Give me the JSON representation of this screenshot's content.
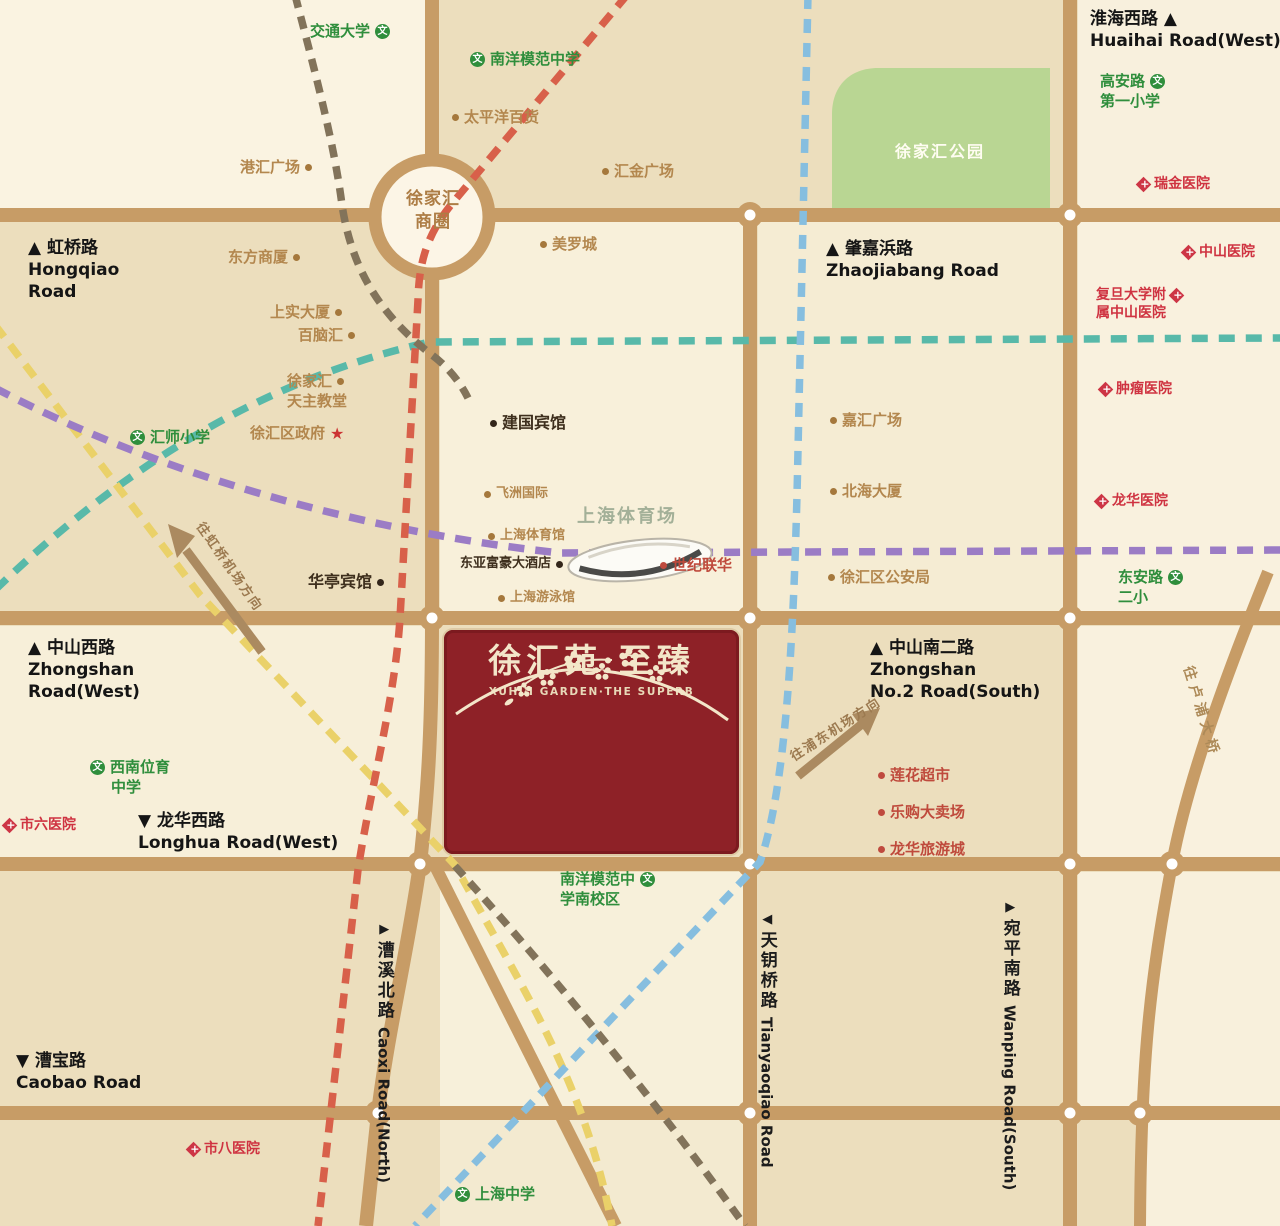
{
  "map": {
    "title": "徐汇苑·至臻 区位图",
    "project": {
      "name_cn": "徐汇苑·至臻",
      "name_en": "XUHUI GARDEN·THE SUPERB"
    },
    "hub": {
      "label": "徐家汇商圈"
    },
    "park": {
      "label": "徐家汇公园"
    },
    "colors": {
      "background": "#ecdebd",
      "block_light": "#f8f0da",
      "road": "#c79c66",
      "project_red": "#8e2127",
      "park_green": "#b9d693",
      "line_red": "#d8604a",
      "line_teal": "#58b9a9",
      "line_purple": "#9b7cc5",
      "line_yellow": "#ead169",
      "line_blue": "#86bedf",
      "line_brown": "#82735a",
      "poi_tan": "#b3874e",
      "school_green": "#2f8e3c",
      "hospital_red": "#cf3341"
    },
    "labels": [
      {
        "n": "poi-jiaotong-university",
        "x": 310,
        "y": 22,
        "c": "school",
        "lines": [
          {
            "t": "交通大学",
            "ic": "school",
            "s": "right"
          }
        ]
      },
      {
        "n": "poi-nanyang-model-school",
        "x": 470,
        "y": 50,
        "c": "school",
        "lines": [
          {
            "t": "南洋模范中学",
            "ic": "school",
            "s": "left"
          }
        ]
      },
      {
        "n": "poi-pacific-department-store",
        "x": 452,
        "y": 108,
        "c": "poi",
        "lines": [
          {
            "t": "太平洋百货",
            "ic": "dot-tan",
            "s": "left"
          }
        ]
      },
      {
        "n": "poi-ganghui-plaza",
        "x": 240,
        "y": 158,
        "c": "poi",
        "lines": [
          {
            "t": "港汇广场",
            "ic": "dot-tan",
            "s": "right"
          }
        ]
      },
      {
        "n": "poi-huijin-plaza",
        "x": 602,
        "y": 162,
        "c": "poi",
        "lines": [
          {
            "t": "汇金广场",
            "ic": "dot-tan",
            "s": "left"
          }
        ]
      },
      {
        "n": "road-huaihai-west",
        "x": 1090,
        "y": 8,
        "c": "roadname",
        "lines": [
          {
            "t": "淮海西路 ▲"
          },
          {
            "t": "Huaihai Road(West)"
          }
        ]
      },
      {
        "n": "poi-gaoan-road-first-primary",
        "x": 1100,
        "y": 72,
        "c": "school",
        "lines": [
          {
            "t": "高安路",
            "ic": "school",
            "s": "right"
          },
          {
            "t": "第一小学"
          }
        ]
      },
      {
        "n": "poi-ruijin-hospital",
        "x": 1138,
        "y": 175,
        "c": "hosp",
        "lines": [
          {
            "t": "瑞金医院",
            "ic": "hospital",
            "s": "left"
          }
        ]
      },
      {
        "n": "road-hongqiao",
        "x": 28,
        "y": 237,
        "c": "roadname",
        "lines": [
          {
            "t": "▲ 虹桥路"
          },
          {
            "t": "Hongqiao"
          },
          {
            "t": "Road"
          }
        ]
      },
      {
        "n": "poi-dongfang-shopping-center",
        "x": 228,
        "y": 248,
        "c": "poi",
        "lines": [
          {
            "t": "东方商厦",
            "ic": "dot-tan",
            "s": "right"
          }
        ]
      },
      {
        "n": "poi-metro-city",
        "x": 540,
        "y": 235,
        "c": "poi",
        "lines": [
          {
            "t": "美罗城",
            "ic": "dot-tan",
            "s": "left"
          }
        ]
      },
      {
        "n": "road-zhaojiabang",
        "x": 826,
        "y": 238,
        "c": "roadname",
        "lines": [
          {
            "t": "▲ 肇嘉浜路"
          },
          {
            "t": "Zhaojiabang Road"
          }
        ]
      },
      {
        "n": "poi-zhongshan-hospital",
        "x": 1183,
        "y": 243,
        "c": "hosp",
        "lines": [
          {
            "t": "中山医院",
            "ic": "hospital",
            "s": "left"
          }
        ]
      },
      {
        "n": "poi-fudan-zhongshan-hospital",
        "x": 1096,
        "y": 286,
        "c": "hosp",
        "lines": [
          {
            "t": "复旦大学附",
            "ic": "hospital",
            "s": "right"
          },
          {
            "t": "属中山医院"
          }
        ]
      },
      {
        "n": "poi-shangshi-tower",
        "x": 270,
        "y": 303,
        "c": "poi",
        "lines": [
          {
            "t": "上实大厦",
            "ic": "dot-tan",
            "s": "right"
          }
        ]
      },
      {
        "n": "poi-bainaohui",
        "x": 298,
        "y": 326,
        "c": "poi",
        "lines": [
          {
            "t": "百脑汇",
            "ic": "dot-tan",
            "s": "right"
          }
        ]
      },
      {
        "n": "poi-xujiahui-cathedral",
        "x": 287,
        "y": 372,
        "c": "poi",
        "lines": [
          {
            "t": "徐家汇",
            "ic": "dot-tan",
            "s": "right"
          },
          {
            "t": "天主教堂"
          }
        ]
      },
      {
        "n": "poi-huishi-primary",
        "x": 130,
        "y": 428,
        "c": "school",
        "lines": [
          {
            "t": "汇师小学",
            "ic": "school",
            "s": "left"
          }
        ]
      },
      {
        "n": "poi-xuhui-district-government",
        "x": 250,
        "y": 424,
        "c": "poi",
        "lines": [
          {
            "t": "徐汇区政府",
            "ic": "star",
            "s": "right"
          }
        ]
      },
      {
        "n": "poi-jianguo-hotel",
        "x": 490,
        "y": 413,
        "c": "poi-dark",
        "lines": [
          {
            "t": "建国宾馆",
            "ic": "dot-dark",
            "s": "left"
          }
        ]
      },
      {
        "n": "poi-jiahui-plaza",
        "x": 830,
        "y": 411,
        "c": "poi",
        "lines": [
          {
            "t": "嘉汇广场",
            "ic": "dot-tan",
            "s": "left"
          }
        ]
      },
      {
        "n": "poi-beihai-tower",
        "x": 830,
        "y": 482,
        "c": "poi",
        "lines": [
          {
            "t": "北海大厦",
            "ic": "dot-tan",
            "s": "left"
          }
        ]
      },
      {
        "n": "poi-cancer-hospital",
        "x": 1100,
        "y": 380,
        "c": "hosp",
        "lines": [
          {
            "t": "肿瘤医院",
            "ic": "hospital",
            "s": "left"
          }
        ]
      },
      {
        "n": "poi-longhua-hospital",
        "x": 1096,
        "y": 492,
        "c": "hosp",
        "lines": [
          {
            "t": "龙华医院",
            "ic": "hospital",
            "s": "left"
          }
        ]
      },
      {
        "n": "poi-feizhou-international",
        "x": 484,
        "y": 486,
        "c": "poi-sm",
        "lines": [
          {
            "t": "飞洲国际",
            "ic": "dot-tan",
            "s": "left"
          }
        ]
      },
      {
        "n": "poi-shanghai-stadium",
        "x": 577,
        "y": 505,
        "c": "stadium",
        "lines": [
          {
            "t": "上海体育场"
          }
        ]
      },
      {
        "n": "poi-shanghai-gymnasium",
        "x": 488,
        "y": 528,
        "c": "poi-sm",
        "lines": [
          {
            "t": "上海体育馆",
            "ic": "dot-tan",
            "s": "left"
          }
        ]
      },
      {
        "n": "poi-dongya-richgate-hotel",
        "x": 460,
        "y": 556,
        "c": "hotel-sm",
        "lines": [
          {
            "t": "东亚富豪大酒店",
            "ic": "dot-dark",
            "s": "right"
          }
        ]
      },
      {
        "n": "poi-shanghai-natatorium",
        "x": 498,
        "y": 590,
        "c": "poi-sm",
        "lines": [
          {
            "t": "上海游泳馆",
            "ic": "dot-tan",
            "s": "left"
          }
        ]
      },
      {
        "n": "poi-century-lianhua",
        "x": 660,
        "y": 556,
        "c": "retail",
        "lines": [
          {
            "t": "世纪联华",
            "ic": "dot-red",
            "s": "left"
          }
        ]
      },
      {
        "n": "poi-huating-hotel",
        "x": 308,
        "y": 572,
        "c": "poi-dark",
        "lines": [
          {
            "t": "华亭宾馆",
            "ic": "dot-dark",
            "s": "right"
          }
        ]
      },
      {
        "n": "poi-dongan-road-second-primary",
        "x": 1118,
        "y": 568,
        "c": "school",
        "lines": [
          {
            "t": "东安路",
            "ic": "school",
            "s": "right"
          },
          {
            "t": "二小"
          }
        ]
      },
      {
        "n": "poi-xuhui-police-bureau",
        "x": 828,
        "y": 568,
        "c": "poi",
        "lines": [
          {
            "t": "徐汇区公安局",
            "ic": "dot-tan",
            "s": "left"
          }
        ]
      },
      {
        "n": "road-zhongshan-west",
        "x": 28,
        "y": 637,
        "c": "roadname",
        "lines": [
          {
            "t": "▲ 中山西路"
          },
          {
            "t": "Zhongshan"
          },
          {
            "t": "Road(West)"
          }
        ]
      },
      {
        "n": "road-zhongshan-no2-south",
        "x": 870,
        "y": 637,
        "c": "roadname",
        "lines": [
          {
            "t": "▲ 中山南二路"
          },
          {
            "t": "Zhongshan"
          },
          {
            "t": "No.2 Road(South)"
          }
        ]
      },
      {
        "n": "poi-xinanweiyu-school",
        "x": 90,
        "y": 758,
        "c": "school",
        "lines": [
          {
            "t": "西南位育",
            "ic": "school",
            "s": "left"
          },
          {
            "t": "中学",
            "pad": 21
          }
        ]
      },
      {
        "n": "poi-sixth-people-hospital",
        "x": 4,
        "y": 816,
        "c": "hosp",
        "lines": [
          {
            "t": "市六医院",
            "ic": "hospital",
            "s": "left"
          }
        ]
      },
      {
        "n": "road-longhua-west",
        "x": 138,
        "y": 810,
        "c": "roadname",
        "lines": [
          {
            "t": "▼ 龙华西路"
          },
          {
            "t": "Longhua Road(West)"
          }
        ]
      },
      {
        "n": "poi-lianhua-supermarket",
        "x": 878,
        "y": 766,
        "c": "retail",
        "lines": [
          {
            "t": "莲花超市",
            "ic": "dot-red",
            "s": "left"
          }
        ]
      },
      {
        "n": "poi-legou-hypermarket",
        "x": 878,
        "y": 803,
        "c": "retail",
        "lines": [
          {
            "t": "乐购大卖场",
            "ic": "dot-red",
            "s": "left"
          }
        ]
      },
      {
        "n": "poi-longhua-tourist-city",
        "x": 878,
        "y": 840,
        "c": "retail",
        "lines": [
          {
            "t": "龙华旅游城",
            "ic": "dot-red",
            "s": "left"
          }
        ]
      },
      {
        "n": "direction-to-pudong-airport",
        "x": 788,
        "y": 752,
        "c": "dir",
        "r": -33,
        "lines": [
          {
            "t": "往浦东机场方向"
          }
        ]
      },
      {
        "n": "direction-to-hongqiao-airport",
        "x": 205,
        "y": 520,
        "c": "dir",
        "r": 55,
        "lines": [
          {
            "t": "往虹桥机场方向"
          }
        ]
      },
      {
        "n": "direction-to-lupu-bridge",
        "x": 1196,
        "y": 664,
        "c": "dir2",
        "r": 73,
        "lines": [
          {
            "t": "往卢浦大桥"
          }
        ]
      },
      {
        "n": "poi-nanyang-model-south-campus",
        "x": 560,
        "y": 870,
        "c": "school",
        "lines": [
          {
            "t": "南洋模范中",
            "ic": "school",
            "s": "right"
          },
          {
            "t": "学南校区"
          }
        ]
      },
      {
        "n": "road-caoxi-north",
        "x": 374,
        "y": 922,
        "v": true,
        "tri": "▶",
        "cn": "漕溪北路",
        "en": "Caoxi Road(North)"
      },
      {
        "n": "poi-eighth-people-hospital",
        "x": 188,
        "y": 1140,
        "c": "hosp",
        "lines": [
          {
            "t": "市八医院",
            "ic": "hospital",
            "s": "left"
          }
        ]
      },
      {
        "n": "road-caobao",
        "x": 16,
        "y": 1050,
        "c": "roadname",
        "lines": [
          {
            "t": "▼ 漕宝路"
          },
          {
            "t": "Caobao Road"
          }
        ]
      },
      {
        "n": "road-tianyaoqiao",
        "x": 757,
        "y": 912,
        "v": true,
        "tri": "◀",
        "cn": "天钥桥路",
        "en": "Tianyaoqiao Road"
      },
      {
        "n": "road-wanping-south",
        "x": 1000,
        "y": 900,
        "v": true,
        "tri": "▶",
        "cn": "宛平南路",
        "en": "Wanping Road(South)"
      },
      {
        "n": "poi-shanghai-high-school",
        "x": 455,
        "y": 1185,
        "c": "school",
        "lines": [
          {
            "t": "上海中学",
            "ic": "school",
            "s": "left"
          }
        ]
      }
    ]
  }
}
